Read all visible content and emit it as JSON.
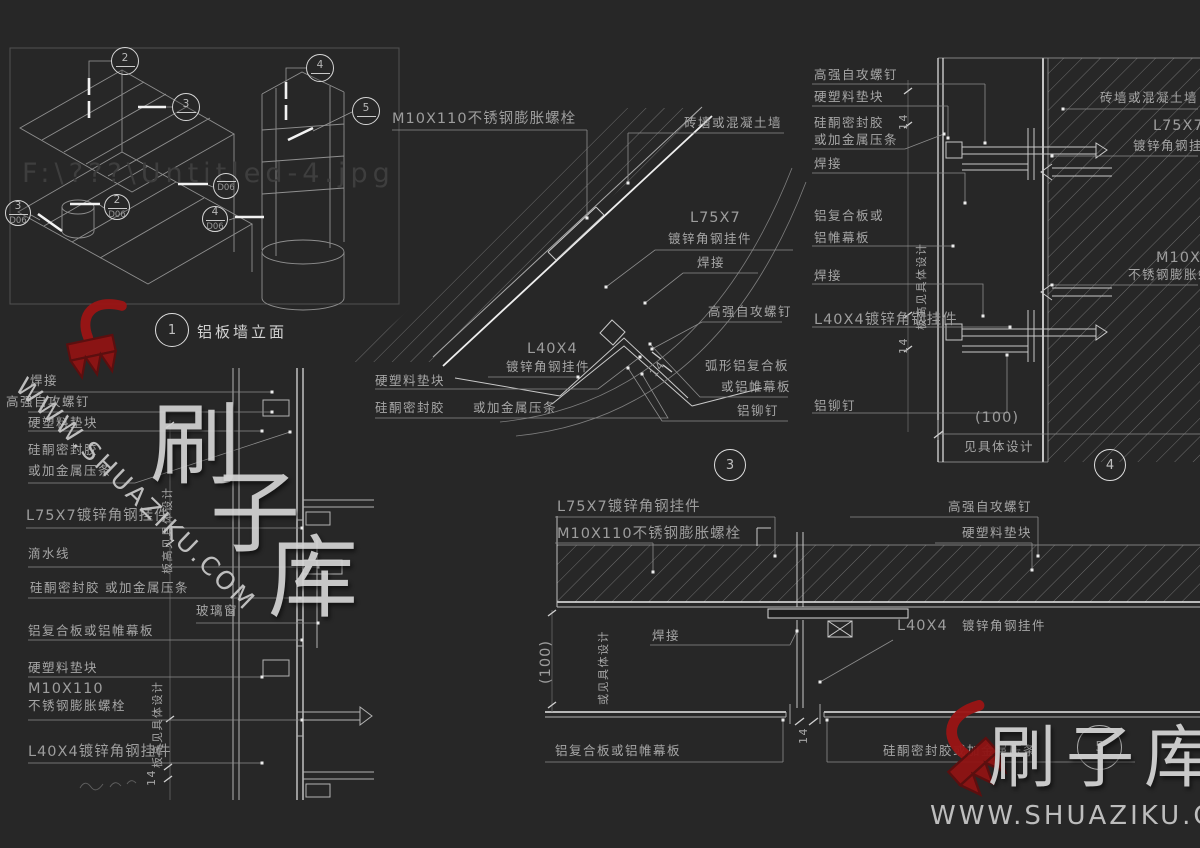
{
  "title": {
    "num": "1",
    "text": "铝板墙立面"
  },
  "markers": {
    "m1": "1",
    "m2": "2",
    "m3": "3",
    "m4": "4",
    "m5": "5",
    "d06": "D06",
    "blank": ""
  },
  "watermark": {
    "site": "WWW.SHUAZIKU.COM",
    "brand": "刷子库",
    "c1": "刷",
    "c2": "子",
    "c3": "库",
    "path_text": "F:\\???\\Untitled-4.jpg"
  },
  "terms": {
    "weld": "焊接",
    "screw": "高强自攻螺钉",
    "pad": "硬塑料垫块",
    "sealant": "硅酮密封胶",
    "strip": "或加金属压条",
    "l75": "L75X7",
    "l75_full": "L75X7镀锌角钢挂件",
    "galv_angle": "镀锌角钢挂件",
    "drip": "滴水线",
    "glass": "玻璃窗",
    "alu_panel": "铝复合板或铝帷幕板",
    "alu_panel_a": "铝复合板或",
    "alu_panel_b": "铝帷幕板",
    "m10": "M10X110",
    "ss_bolt": "不锈钢膨胀螺栓",
    "m10_full": "M10X110不锈钢膨胀螺栓",
    "l40": "L40X4",
    "l40_full": "L40X4镀锌角钢挂件",
    "wall": "砖墙或混凝土墙",
    "curved_panel": "弧形铝复合板",
    "curved_panel2": "或铝帷幕板",
    "rivet": "铝铆钉",
    "dim_100": "(100)",
    "dim_14": "14",
    "see_design": "见具体设计",
    "or_see_design": "或见具体设计",
    "board_height": "板高见具体设计"
  }
}
